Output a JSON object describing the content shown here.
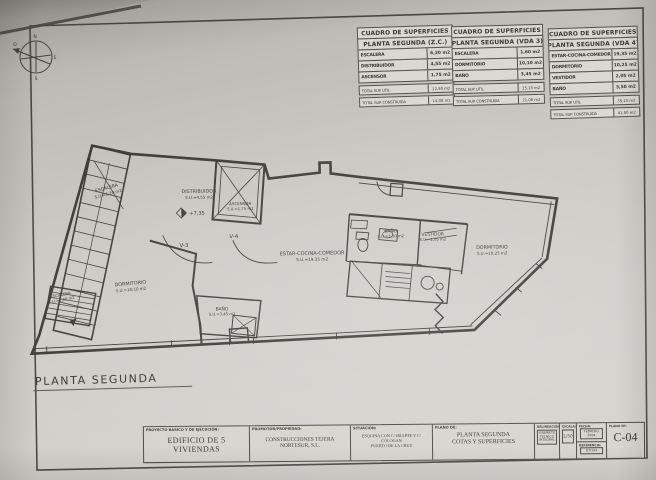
{
  "compass": {
    "n": "N",
    "s": "S",
    "e": "E",
    "o": "O"
  },
  "tables": [
    {
      "title": "CUADRO DE SUPERFICIES",
      "subtitle": "PLANTA SEGUNDA (Z.C.)",
      "rows": [
        {
          "label": "ESCALERA",
          "value": "6,20 m2"
        },
        {
          "label": "DISTRIBUIDOR",
          "value": "4,55 m2"
        },
        {
          "label": "ASCENSOR",
          "value": "1,75 m2"
        }
      ],
      "total_util": {
        "label": "TOTAL SUP. UTIL",
        "value": "12,50 m2"
      },
      "total_construida": {
        "label": "TOTAL SUP. CONSTRUIDA",
        "value": "14,08 m2"
      }
    },
    {
      "title": "CUADRO DE SUPERFICIES",
      "subtitle": "PLANTA SEGUNDA (VDA 3)",
      "rows": [
        {
          "label": "ESCALERA",
          "value": "1,60 m2"
        },
        {
          "label": "DORMITORIO",
          "value": "10,10 m2"
        },
        {
          "label": "BAÑO",
          "value": "3,45 m2"
        }
      ],
      "total_util": {
        "label": "TOTAL SUP. UTIL",
        "value": "15,15 m2"
      },
      "total_construida": {
        "label": "TOTAL SUP. CONSTRUIDA",
        "value": "21,08 m2"
      }
    },
    {
      "title": "CUADRO DE SUPERFICIES",
      "subtitle": "PLANTA SEGUNDA (VDA 4)",
      "rows": [
        {
          "label": "ESTAR-COCINA-COMEDOR",
          "value": "19,35 m2"
        },
        {
          "label": "DORMITORIO",
          "value": "10,25 m2"
        },
        {
          "label": "VESTIDOR",
          "value": "2,05 m2"
        },
        {
          "label": "BAÑO",
          "value": "3,50 m2"
        }
      ],
      "total_util": {
        "label": "TOTAL SUP. UTIL",
        "value": "35,15 m2"
      },
      "total_construida": {
        "label": "TOTAL SUP. CONSTRUIDA",
        "value": "41,00 m2"
      }
    }
  ],
  "plan": {
    "caption": "PLANTA SEGUNDA",
    "labels": {
      "escalera_top": {
        "name": "ESCALERA",
        "area": "S.U.=6,20 m2"
      },
      "distribuidor": {
        "name": "DISTRIBUIDOR",
        "area": "S.U.=4,55 m2"
      },
      "ascensor": {
        "name": "ASCENSOR",
        "area": "S.U.=1,75 m2"
      },
      "nivel": "+7,35",
      "v3": "V-3",
      "v4": "V-4",
      "estar": {
        "name": "ESTAR-COCINA-COMEDOR",
        "area": "S.U.=19,35 m2"
      },
      "bano_vda4": {
        "name": "BAÑO",
        "area": "S.U.=3,50 m2"
      },
      "vestidor": {
        "name": "VESTIDOR",
        "area": "S.U.=2,05 m2"
      },
      "dormitorio_der": {
        "name": "DORMITORIO",
        "area": "S.U.=10,25 m2"
      },
      "dormitorio_izq": {
        "name": "DORMITORIO",
        "area": "S.U.=10,10 m2"
      },
      "bano_vda3": {
        "name": "BAÑO",
        "area": "S.U.=3,45 m2"
      },
      "escalera_baja": {
        "name": "ESCALERA",
        "area": "S.U.=1,60 m2"
      }
    }
  },
  "titleblock": {
    "proyecto": {
      "header": "PROYECTO  BÁSICO  Y  DE  EJECUCIÓN:",
      "value": "EDIFICIO DE 5 VIVIENDAS"
    },
    "promotor": {
      "header": "PROMOTOR/PROPIEDAD:",
      "value": "CONSTRUCCIONES TEJERA NORTESUR, S.L."
    },
    "situacion": {
      "header": "SITUACIÓN:",
      "line1": "ESQUINA CON C/ IRIARTE Y C/ CÓLOGAN",
      "line2": "PUERTO DE LA CRUZ"
    },
    "plano_de": {
      "header": "PLANO  DE:",
      "line1": "PLANTA SEGUNDA",
      "line2": "COTAS Y SUPERFICIES"
    },
    "delineacion": {
      "header": "DELINEACIÓN:",
      "l1": "GABINETE",
      "l2": "TECNICO",
      "l3": "INTEGRAL"
    },
    "escala": {
      "header": "ESCALA:",
      "value": "1/50"
    },
    "fecha": {
      "header": "FECHA:",
      "value": "FEBRERO 2004"
    },
    "referencia": {
      "header": "REFERENCIA:",
      "value": "03/143"
    },
    "plano_num": {
      "header": "PLANO Nº:",
      "value": "C-04"
    }
  }
}
